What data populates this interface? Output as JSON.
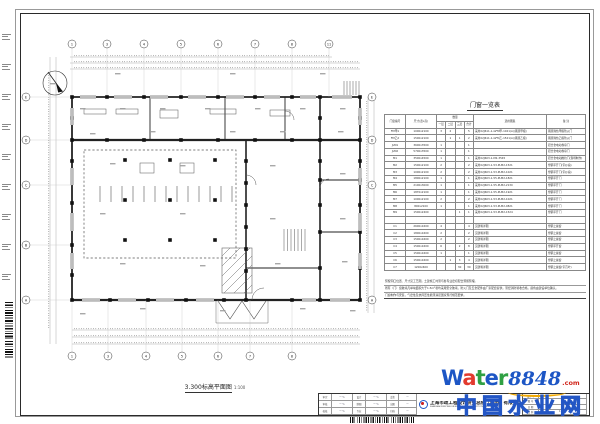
{
  "plan": {
    "title": "3.300标高平面图",
    "scale": "1:100",
    "axes_top": {
      "labels": [
        "1",
        "3",
        "4",
        "5",
        "6",
        "7",
        "8",
        "11"
      ],
      "x": [
        52,
        87,
        124,
        161,
        198,
        235,
        272,
        309
      ],
      "y": 31
    },
    "axes_bottom": {
      "labels": [
        "1",
        "3",
        "4",
        "5",
        "6",
        "7",
        "8"
      ],
      "x": [
        52,
        88,
        126,
        162,
        198,
        230,
        272
      ],
      "y": 343
    },
    "axes_left": {
      "labels": [
        "E",
        "D",
        "C",
        "B",
        "A"
      ],
      "y": [
        84,
        127,
        172,
        232,
        287
      ],
      "x": 6
    },
    "axes_right": {
      "labels": [
        "E",
        "D",
        "C",
        "A"
      ],
      "y": [
        84,
        127,
        172,
        287
      ],
      "x": 352
    },
    "columns": [
      [
        52,
        84
      ],
      [
        87,
        84
      ],
      [
        124,
        84
      ],
      [
        161,
        84
      ],
      [
        198,
        84
      ],
      [
        235,
        84
      ],
      [
        272,
        84
      ],
      [
        300,
        84
      ],
      [
        340,
        84
      ],
      [
        52,
        127
      ],
      [
        87,
        127
      ],
      [
        124,
        127
      ],
      [
        161,
        127
      ],
      [
        198,
        127
      ],
      [
        235,
        127
      ],
      [
        272,
        127
      ],
      [
        300,
        127
      ],
      [
        340,
        127
      ],
      [
        52,
        287
      ],
      [
        90,
        287
      ],
      [
        128,
        287
      ],
      [
        166,
        287
      ],
      [
        204,
        287
      ],
      [
        226,
        287
      ],
      [
        272,
        287
      ],
      [
        300,
        287
      ],
      [
        340,
        287
      ],
      [
        52,
        105
      ],
      [
        52,
        148
      ],
      [
        52,
        190
      ],
      [
        52,
        232
      ],
      [
        52,
        262
      ],
      [
        226,
        148
      ],
      [
        226,
        170
      ],
      [
        226,
        192
      ],
      [
        226,
        214
      ],
      [
        226,
        236
      ],
      [
        226,
        258
      ],
      [
        300,
        105
      ],
      [
        300,
        148
      ],
      [
        300,
        167
      ],
      [
        300,
        192
      ],
      [
        300,
        219
      ],
      [
        300,
        255
      ],
      [
        340,
        105
      ],
      [
        340,
        148
      ],
      [
        340,
        167
      ],
      [
        340,
        192
      ],
      [
        340,
        219
      ],
      [
        340,
        255
      ],
      [
        105,
        147
      ],
      [
        150,
        147
      ],
      [
        195,
        147
      ],
      [
        105,
        187
      ],
      [
        150,
        187
      ],
      [
        195,
        187
      ],
      [
        105,
        227
      ],
      [
        150,
        227
      ],
      [
        195,
        227
      ]
    ],
    "specks": [
      [
        60,
        95
      ],
      [
        100,
        95
      ],
      [
        140,
        95
      ],
      [
        185,
        95
      ],
      [
        235,
        95
      ],
      [
        280,
        95
      ],
      [
        320,
        95
      ],
      [
        70,
        120
      ],
      [
        130,
        118
      ],
      [
        210,
        118
      ],
      [
        260,
        118
      ],
      [
        318,
        118
      ],
      [
        90,
        150
      ],
      [
        160,
        152
      ],
      [
        250,
        152
      ],
      [
        320,
        160
      ],
      [
        80,
        200
      ],
      [
        160,
        200
      ],
      [
        250,
        205
      ],
      [
        320,
        205
      ],
      [
        100,
        250
      ],
      [
        180,
        252
      ],
      [
        255,
        250
      ],
      [
        322,
        248
      ],
      [
        120,
        295
      ],
      [
        200,
        297
      ],
      [
        280,
        295
      ],
      [
        60,
        300
      ],
      [
        330,
        297
      ],
      [
        30,
        70
      ],
      [
        95,
        60
      ],
      [
        210,
        60
      ],
      [
        300,
        60
      ]
    ],
    "windows_top": [
      [
        60,
        76
      ],
      [
        94,
        112
      ],
      [
        130,
        148
      ],
      [
        168,
        186
      ],
      [
        206,
        224
      ],
      [
        244,
        260
      ],
      [
        280,
        296
      ],
      [
        312,
        332
      ]
    ],
    "windows_bottom": [
      [
        62,
        80
      ],
      [
        98,
        116
      ],
      [
        136,
        154
      ],
      [
        176,
        194
      ],
      [
        282,
        296
      ],
      [
        310,
        330
      ]
    ],
    "windows_left": [
      [
        95,
        112
      ],
      [
        155,
        172
      ],
      [
        200,
        218
      ],
      [
        240,
        256
      ]
    ],
    "windows_right": [
      [
        95,
        112
      ],
      [
        155,
        172
      ],
      [
        200,
        218
      ],
      [
        240,
        256
      ]
    ],
    "slats": {
      "x0": 80,
      "step": 11,
      "n": 13,
      "y1": 173,
      "y2": 189
    },
    "stairs": [
      {
        "x0": 264,
        "step": 3.5,
        "n": 7,
        "y1": 216,
        "y2": 238
      },
      {
        "x0": 324,
        "step": 3,
        "n": 6,
        "y1": 68,
        "y2": 82
      }
    ],
    "hatch": {
      "x": 202,
      "y": 235,
      "w": 30,
      "h": 45,
      "step": 5
    }
  },
  "schedule": {
    "title": "门窗一览表",
    "headers": {
      "id": "门窗编号",
      "size": "尺寸(宽x高)",
      "qty": "数量",
      "floors": [
        "一层",
        "二层",
        "三层",
        "合计"
      ],
      "atlas": "选用图集",
      "remark": "备 注"
    },
    "rows": [
      [
        "FM甲1",
        "1000x2100",
        "3",
        "2",
        "",
        "5",
        "采用02J611-1-GFM甲-1021(A)(钢质甲级)",
        "钢质隔热甲级防火门"
      ],
      [
        "FM乙2",
        "1500x2100",
        "",
        "1",
        "1",
        "2",
        "采用02J611-1-GFM乙-1521(A)(钢质乙级)",
        "钢质隔热乙级防火门"
      ],
      [
        "JLM1",
        "3600x3500",
        "1",
        "",
        "",
        "1",
        "",
        "铝合金电动卷帘门"
      ],
      [
        "JLM2",
        "5700x3500",
        "1",
        "",
        "",
        "1",
        "",
        "铝合金电动卷帘门"
      ],
      [
        "M1",
        "3500x4500",
        "1",
        "",
        "",
        "1",
        "采用02J603-1-M2-3545",
        "铝合金电动推拉门(现场制作)"
      ],
      [
        "M2",
        "1500x2100",
        "2",
        "",
        "",
        "2",
        "采用02J603-1-53-PLM2-1521",
        "塑钢平开门(带纱扇)"
      ],
      [
        "M3",
        "1000x2100",
        "2",
        "",
        "",
        "2",
        "采用02J603-1-53-PLM2-1021",
        "塑钢平开门(带纱扇)"
      ],
      [
        "M4",
        "1800x2100",
        "1",
        "",
        "",
        "1",
        "采用02J603-1-55-PLM2-1821",
        "塑钢平开门"
      ],
      [
        "M5",
        "2100x3000",
        "1",
        "",
        "",
        "1",
        "采用02J603-1-55-PLM2-2130",
        "塑钢平开门"
      ],
      [
        "M6",
        "1870x2100",
        "1",
        "",
        "",
        "1",
        "采用02J603-1-55-PLM2-1921",
        "塑钢平开门"
      ],
      [
        "M7",
        "1000x2100",
        "2",
        "",
        "",
        "2",
        "采用02J603-1-53-PLM2-1021",
        "塑钢平开门"
      ],
      [
        "M8",
        "800x2100",
        "1",
        "",
        "",
        "1",
        "采用02J603-1-53-PLM2-0821",
        "塑钢平开门"
      ],
      [
        "M9",
        "1500x2400",
        "",
        "",
        "1",
        "1",
        "采用02J603-1-53-PLM2-1524",
        "塑钢平开门"
      ],
      [
        "",
        "",
        "",
        "",
        "",
        "",
        "",
        ""
      ],
      [
        "C1",
        "2600x1600",
        "4",
        "",
        "",
        "4",
        "见建筑详图",
        "塑钢上悬窗"
      ],
      [
        "C2",
        "1800x1600",
        "2",
        "",
        "",
        "2",
        "见建筑详图",
        "塑钢上悬窗"
      ],
      [
        "C3",
        "1500x1600",
        "2",
        "",
        "",
        "2",
        "见建筑详图",
        "塑钢上悬窗"
      ],
      [
        "C4",
        "1500x1600",
        "6",
        "",
        "2",
        "8",
        "见建筑详图",
        "塑钢平开窗"
      ],
      [
        "C5",
        "1500x1600",
        "1",
        "",
        "",
        "1",
        "见建筑详图",
        "塑钢上悬窗"
      ],
      [
        "C6",
        "1500x1600",
        "",
        "1",
        "3",
        "4",
        "见建筑详图",
        "塑钢上悬窗"
      ],
      [
        "C7",
        "1200x600",
        "",
        "",
        "30",
        "30",
        "见建筑详图",
        "塑钢上悬窗(带百叶)"
      ]
    ]
  },
  "notes": {
    "lines": [
      "预留洞口位置、尺寸见工艺图，土建施工时须与各专业密切配合预留预埋。",
      "所有（门）窗玻璃凡单块面积大于1.5m²者均采用安全玻璃，防火门及五金配件由厂家配套提供，须经消防验收合格，颜色由建设单位确认。",
      "门窗制作与安装，气密性及抗风压性能须满足国家现行规范要求。"
    ]
  },
  "titleblock": {
    "sig_labels": [
      [
        "审定",
        "设计"
      ],
      [
        "审核",
        "制图"
      ],
      [
        "校核",
        "专业"
      ]
    ],
    "stamp_labels": [
      "会签",
      "出图",
      "归档"
    ],
    "company": "上海市政工程设计研究总院（集团）有限公司",
    "company_en": "SHANGHAI MUNICIPAL ENGINEERING DESIGN INSTITUTE (GROUP) CO., LTD.",
    "meta_labels": [
      "设计号",
      "图 号",
      "日 期",
      "比 例"
    ],
    "meta_values": [
      "",
      "",
      "",
      "1:100"
    ]
  },
  "watermark": {
    "letters": [
      {
        "ch": "W",
        "color": "#1d56c5"
      },
      {
        "ch": "a",
        "color": "#e23a2e"
      },
      {
        "ch": "t",
        "color": "#2fa043"
      },
      {
        "ch": "e",
        "color": "#1d56c5"
      },
      {
        "ch": "r",
        "color": "#2fa043"
      }
    ],
    "number": "8848",
    "dotcom": ".com",
    "cn": "中国水业网",
    "accent_blue": "#1d56c5",
    "accent_red": "#e23a2e",
    "accent_green": "#2fa043",
    "accent_yellow": "#f2a900"
  }
}
